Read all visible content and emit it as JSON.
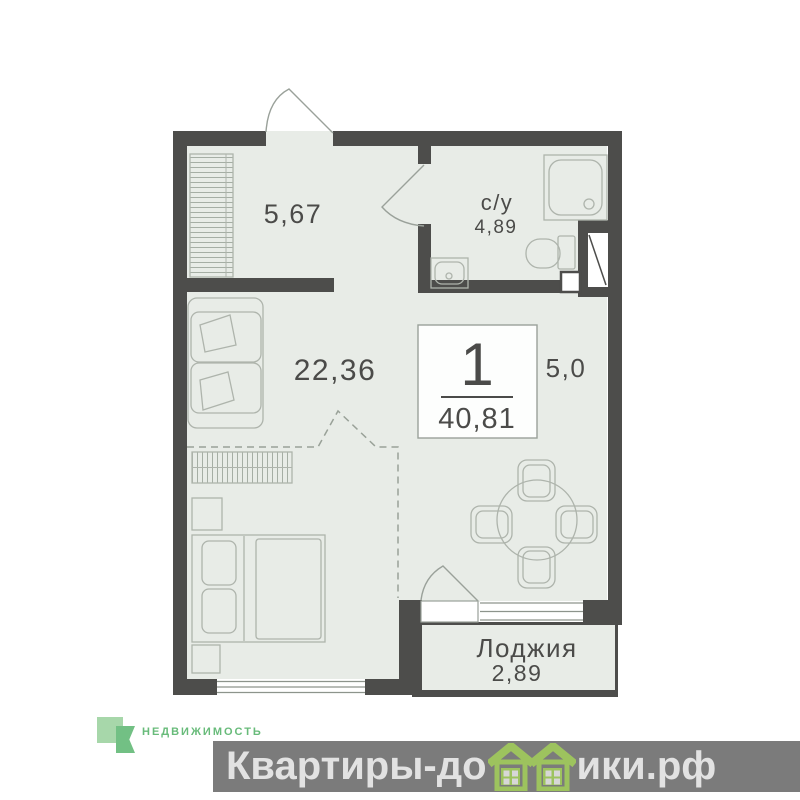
{
  "floor_plan": {
    "hallway_area": "5,67",
    "bathroom_name": "с/у",
    "bathroom_area": "4,89",
    "living_area": "22,36",
    "kitchen_area": "5,0",
    "loggia_name": "Лоджия",
    "loggia_area": "2,89",
    "rooms_count": "1",
    "total_area": "40,81"
  },
  "branding": {
    "agency": "НЕДВИЖИМОСТЬ"
  },
  "watermark": {
    "prefix": "Квартиры-до",
    "suffix": "ики.рф"
  },
  "colors": {
    "wall": "#4d4d4b",
    "floor": "#e8ece7",
    "furniture_line": "#aeb4ac",
    "label_text": "#4b4b49",
    "logo_light_green": "#a7d7aa",
    "logo_dark_green": "#72c084",
    "logo_text_green": "#68bb7a",
    "watermark_bar": "#7b7b7b",
    "watermark_text": "#e2e2e2",
    "house_green": "#9dc35e"
  }
}
